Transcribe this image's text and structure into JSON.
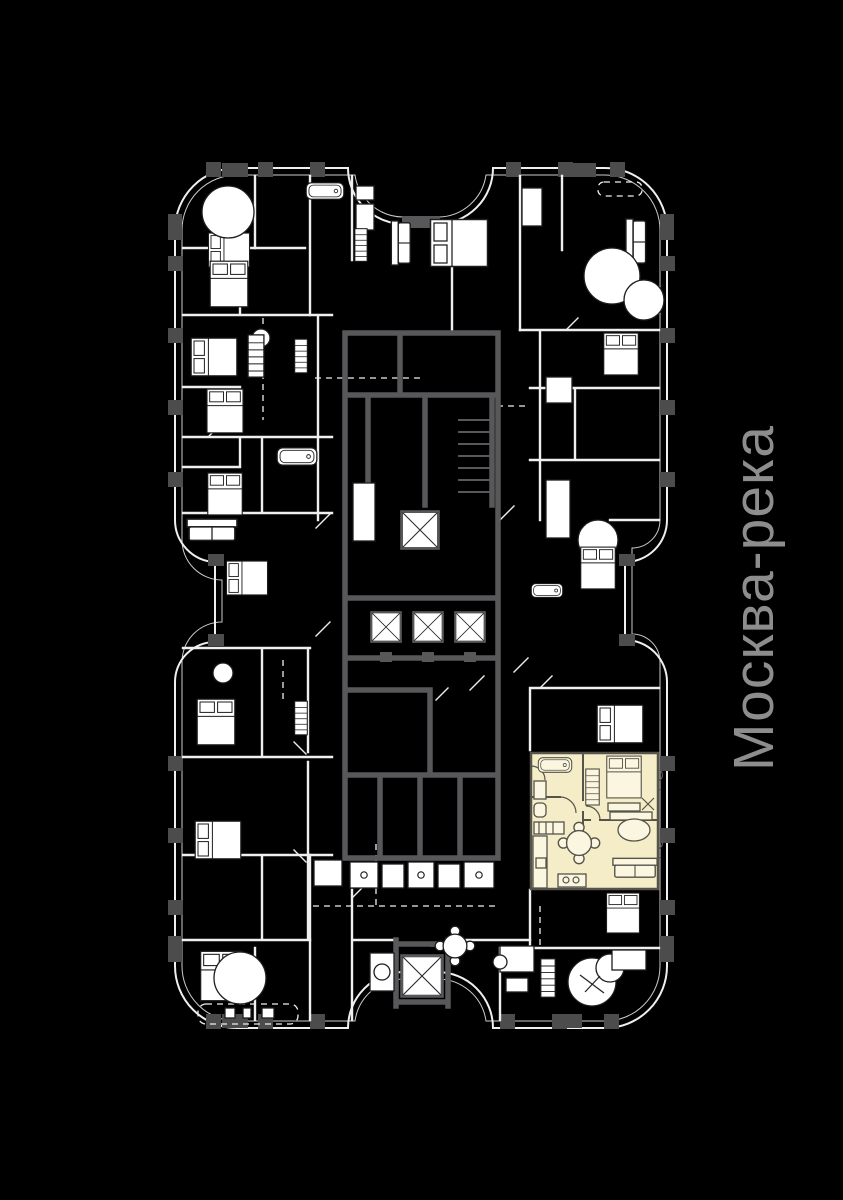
{
  "page": {
    "width": 843,
    "height": 1200,
    "background": "#000000"
  },
  "river_label": {
    "text": "Москва-река",
    "color": "#8d8d8d",
    "orientation": "rotated-90-ccw"
  },
  "floor_plan": {
    "colors": {
      "bg": "#000000",
      "walls": "#efefef",
      "core": "#58585a",
      "pier": "#4c4c4c",
      "highlight": "#f4edc7",
      "highlight_line": "#56534b",
      "furn": "#ffffff",
      "furn_line": "#1d1d1d",
      "label": "#8d8d8d"
    },
    "elevator_count": 3,
    "service_shaft_count": 1,
    "stair_shaft_count": 1,
    "highlighted_apartment": {
      "selected": true
    }
  }
}
